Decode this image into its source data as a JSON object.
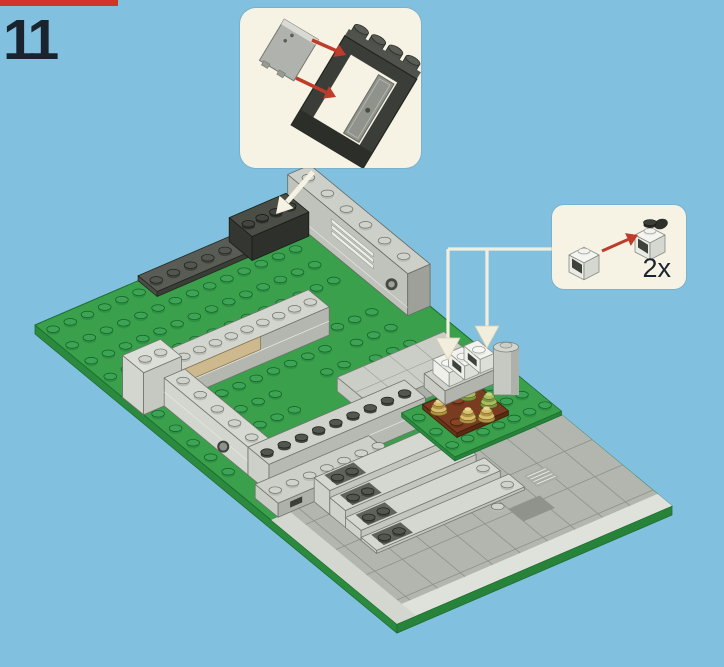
{
  "page": {
    "step_number": "11"
  },
  "callouts": {
    "window_assembly": {
      "part": "window-frame-with-glass-pane"
    },
    "parts_quantity": {
      "part": "1x1-headlight-brick",
      "quantity_label": "2x"
    }
  },
  "colors": {
    "background": "#82c0e0",
    "red_strip": "#d2332a",
    "step_text": "#19242e",
    "callout_bg": "#f7f3e4",
    "callout_line": "#f2eedd",
    "guide_arrow": "#f5f2e3",
    "red_arrow": "#bf3b2a",
    "green_top": "#3aa04c",
    "green_side": "#2c8a3e",
    "green_dark": "#1c6f30",
    "green_stud_top": "#3da455",
    "green_stud_side": "#2f8f43",
    "green_stud_line": "#135f26",
    "gray_light": "#d3d6cf",
    "gray_mid": "#b4b7af",
    "plaza": "#b2b6ae",
    "plaza_line": "#8d9189",
    "plaza_light": "#dfe2db",
    "tan": "#cdb98d",
    "dirt_top": "#7a3c20",
    "white_brick": "#f2f3ee",
    "window_dark": "#3a3d38",
    "pane_gray": "#b0b3ad"
  }
}
